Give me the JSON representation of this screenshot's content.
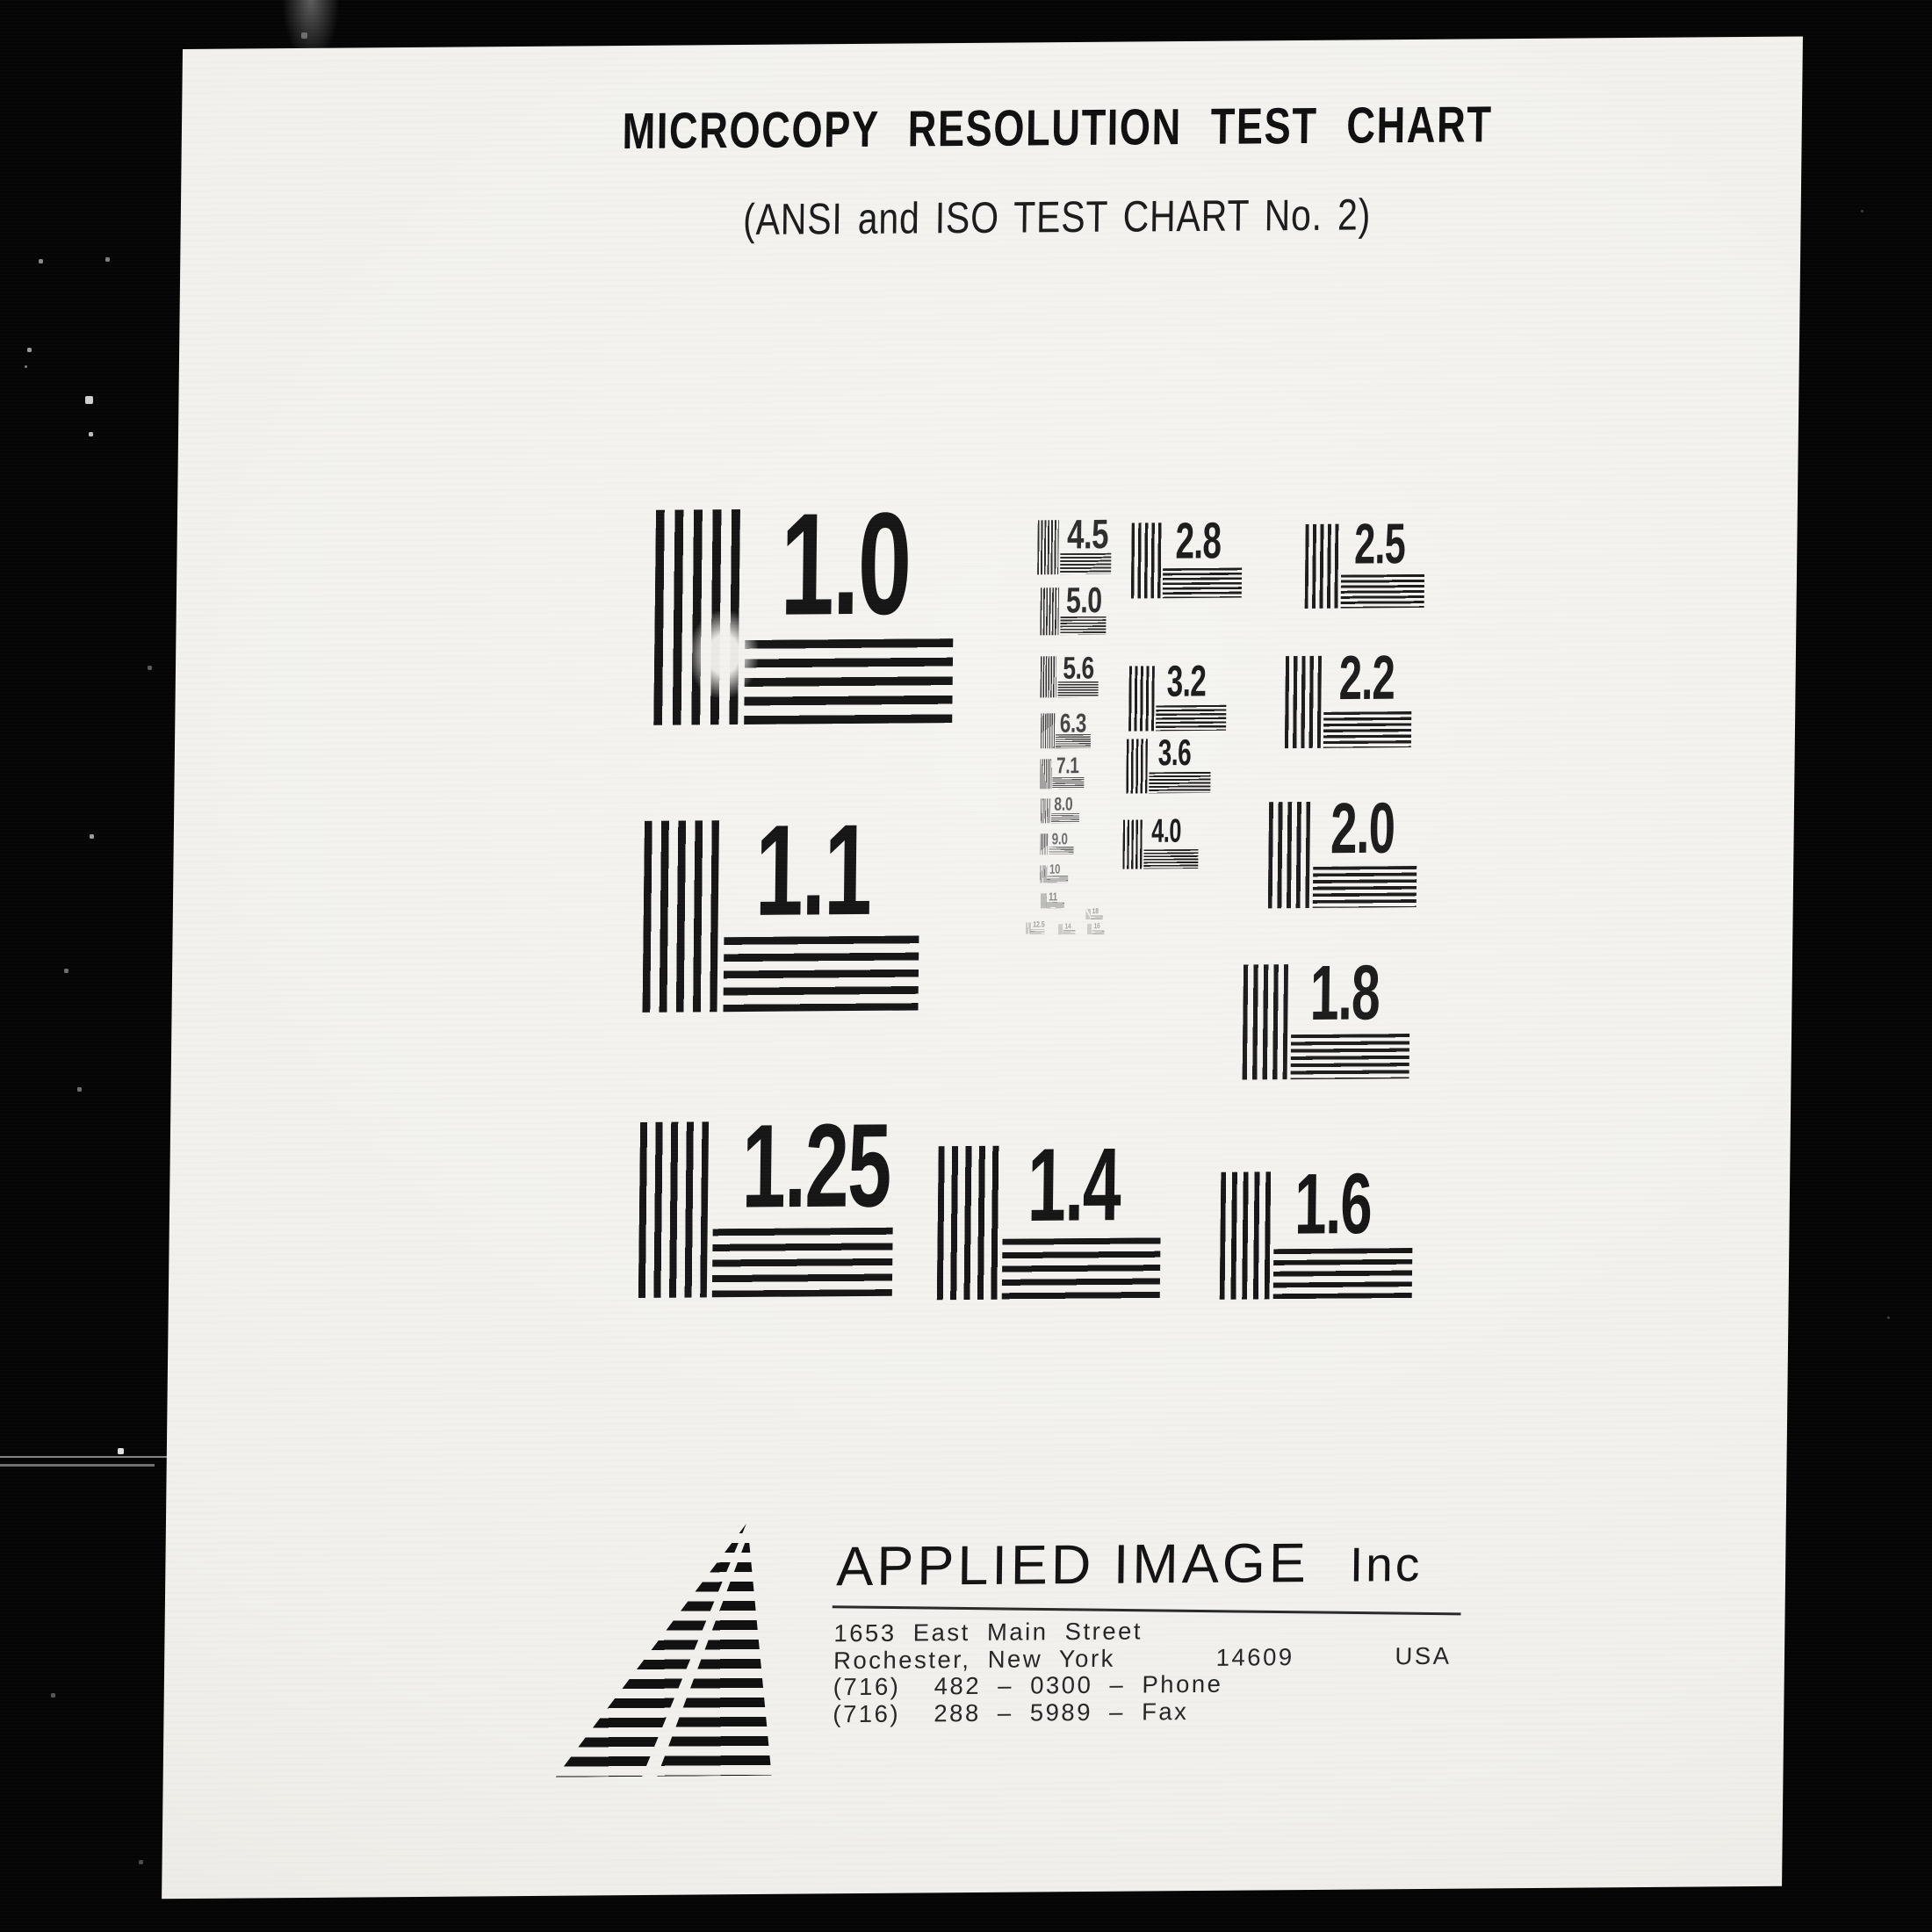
{
  "scan": {
    "title": "MICROCOPY RESOLUTION TEST CHART",
    "subtitle": "(ANSI and ISO TEST CHART No. 2)"
  },
  "patterns": [
    {
      "label": "1.0"
    },
    {
      "label": "1.1"
    },
    {
      "label": "1.25"
    },
    {
      "label": "1.4"
    },
    {
      "label": "1.6"
    },
    {
      "label": "1.8"
    },
    {
      "label": "2.0"
    },
    {
      "label": "2.2"
    },
    {
      "label": "2.5"
    },
    {
      "label": "2.8"
    },
    {
      "label": "3.2"
    },
    {
      "label": "3.6"
    },
    {
      "label": "4.0"
    },
    {
      "label": "4.5"
    },
    {
      "label": "5.0"
    },
    {
      "label": "5.6"
    },
    {
      "label": "6.3"
    },
    {
      "label": "7.1"
    },
    {
      "label": "8.0"
    },
    {
      "label": "9.0"
    },
    {
      "label": "10"
    },
    {
      "label": "11"
    },
    {
      "label": "12.5"
    },
    {
      "label": "14"
    },
    {
      "label": "16"
    },
    {
      "label": "18"
    }
  ],
  "footer": {
    "company": "APPLIED IMAGE",
    "suffix": "Inc",
    "street": "1653 East Main Street",
    "city_line": "Rochester, New York      14609      USA",
    "phone": "(716)  482 – 0300 – Phone",
    "fax": "(716)  288 – 5989 – Fax"
  },
  "colors": {
    "paper": "#f2f1ed",
    "ink": "#141414",
    "background": "#050505"
  }
}
